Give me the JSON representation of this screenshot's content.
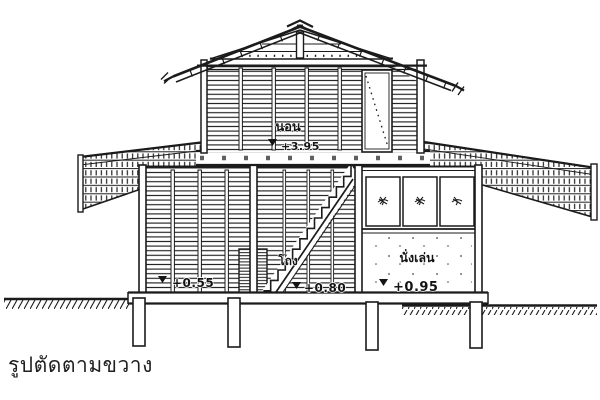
{
  "colors": {
    "ink": "#1b1b1b",
    "paper": "#ffffff"
  },
  "labels": {
    "caption": "รูปตัดตามขวาง",
    "bedroom": {
      "name": "นอน",
      "level": "+3.95"
    },
    "hall": {
      "name": "โถง",
      "level": "+0.80"
    },
    "living": {
      "name": "นั่งเล่น",
      "level": "+0.95"
    },
    "terrace": {
      "level": "+0.55"
    }
  }
}
